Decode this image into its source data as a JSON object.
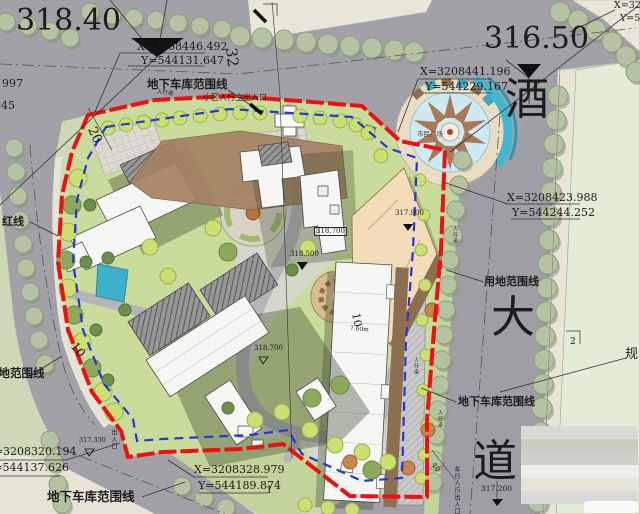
{
  "plan": {
    "spot_elevation_left": "318.40",
    "spot_elevation_right": "316.50",
    "coordinates": {
      "top_left_x": "X=3208446.492",
      "top_left_y": "Y=544131.647",
      "top_right_x": "X=3208441.196",
      "top_right_y": "Y=544229.167",
      "right_x": "X=3208423.988",
      "right_y": "Y=544244.252",
      "bottom_left_x": "X=3208320.194",
      "bottom_left_y": "Y=544137.626",
      "bottom_center_x": "X=3208328.979",
      "bottom_center_y": "Y=544189.874",
      "corner_partial_x": "X=32",
      "corner_partial_y": "Y=5",
      "edge_partial_1": "997",
      "edge_partial_2": "845"
    },
    "boundary_labels": {
      "garage_top": "地下车库范围线",
      "garage_right": "地下车库范围线",
      "garage_bottom": "地下车库范围线",
      "site_right": "用地范围线",
      "site_left": "用地范围线",
      "red_line": "红线"
    },
    "entrance_labels": {
      "main_pedestrian": "小区人行主出入口",
      "vehicle_pedestrian": "车行人行出入口",
      "bottom_exit": "出入口"
    },
    "street_name": {
      "char_1": "酒",
      "char_2": "大",
      "char_3": "道"
    },
    "adjacent_label_partial": "规",
    "plaza_label": "市民广场",
    "sidewalk_labels": {
      "top": "人行道",
      "right": "人行道",
      "mid": "人行道",
      "lower": "人行道"
    },
    "dimensions": {
      "d32": "32",
      "d20": "20",
      "d10_left": "10",
      "d10_right": "10",
      "d40": "40",
      "d2": "2",
      "d760": "7.60m",
      "point_1": "1"
    },
    "spot_elevations_small": {
      "e_318700_box": "318.700",
      "e_318500": "318.500",
      "e_318700": "318.700",
      "e_317900": "317.900",
      "e_317330": "317.330",
      "e_317200": "317.200"
    }
  }
}
